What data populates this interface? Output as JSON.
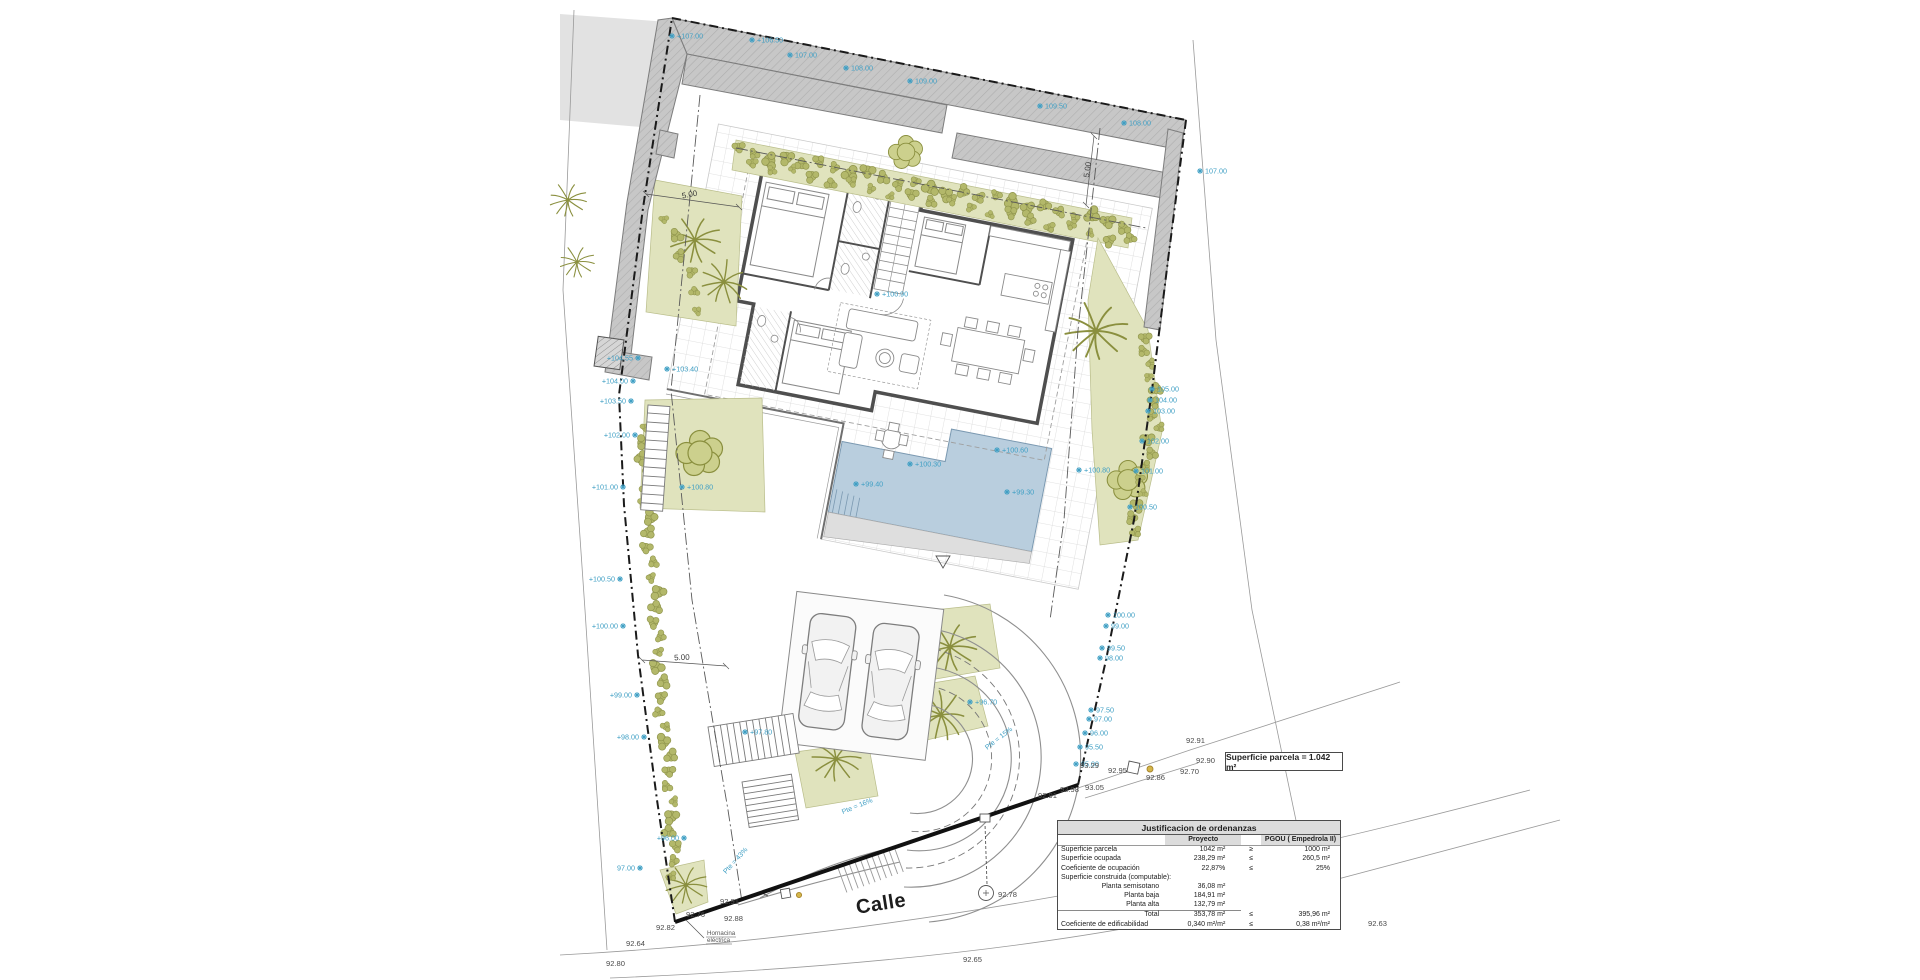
{
  "labels": {
    "street": "Calle",
    "parcel_area_box": "Superficie parcela = 1.042 m²",
    "electrical_niche": "Hornacina eléctrica"
  },
  "spot_elevations": [
    {
      "t": "+107.00",
      "x": 672,
      "y": 36,
      "a": "s"
    },
    {
      "t": "+106.50",
      "x": 752,
      "y": 40,
      "a": "s"
    },
    {
      "t": "107.00",
      "x": 790,
      "y": 55,
      "a": "s"
    },
    {
      "t": "108.00",
      "x": 846,
      "y": 68,
      "a": "s"
    },
    {
      "t": "109.00",
      "x": 910,
      "y": 81,
      "a": "s"
    },
    {
      "t": "109.50",
      "x": 1040,
      "y": 106,
      "a": "s"
    },
    {
      "t": "108.00",
      "x": 1124,
      "y": 123,
      "a": "s"
    },
    {
      "t": "107.00",
      "x": 1200,
      "y": 171,
      "a": "s"
    },
    {
      "t": "+104.55",
      "x": 638,
      "y": 358,
      "a": "e"
    },
    {
      "t": "+104.00",
      "x": 633,
      "y": 381,
      "a": "e"
    },
    {
      "t": "+103.50",
      "x": 631,
      "y": 401,
      "a": "e"
    },
    {
      "t": "+102.00",
      "x": 635,
      "y": 435,
      "a": "e"
    },
    {
      "t": "+101.00",
      "x": 623,
      "y": 487,
      "a": "e"
    },
    {
      "t": "+100.50",
      "x": 620,
      "y": 579,
      "a": "e"
    },
    {
      "t": "+100.00",
      "x": 623,
      "y": 626,
      "a": "e"
    },
    {
      "t": "+99.00",
      "x": 637,
      "y": 695,
      "a": "e"
    },
    {
      "t": "+98.00",
      "x": 644,
      "y": 737,
      "a": "e"
    },
    {
      "t": "+96.00",
      "x": 684,
      "y": 838,
      "a": "e"
    },
    {
      "t": "97.00",
      "x": 640,
      "y": 868,
      "a": "e"
    },
    {
      "t": "105.00",
      "x": 1152,
      "y": 389,
      "a": "s"
    },
    {
      "t": "104.00",
      "x": 1150,
      "y": 400,
      "a": "s"
    },
    {
      "t": "103.00",
      "x": 1148,
      "y": 411,
      "a": "s"
    },
    {
      "t": "102.00",
      "x": 1142,
      "y": 441,
      "a": "s"
    },
    {
      "t": "101.00",
      "x": 1136,
      "y": 471,
      "a": "s"
    },
    {
      "t": "100.50",
      "x": 1130,
      "y": 507,
      "a": "s"
    },
    {
      "t": "100.00",
      "x": 1108,
      "y": 615,
      "a": "s"
    },
    {
      "t": "99.00",
      "x": 1106,
      "y": 626,
      "a": "s"
    },
    {
      "t": "99.50",
      "x": 1102,
      "y": 648,
      "a": "s"
    },
    {
      "t": "98.00",
      "x": 1100,
      "y": 658,
      "a": "s"
    },
    {
      "t": "97.50",
      "x": 1091,
      "y": 710,
      "a": "s"
    },
    {
      "t": "97.00",
      "x": 1089,
      "y": 719,
      "a": "s"
    },
    {
      "t": "96.00",
      "x": 1085,
      "y": 733,
      "a": "s"
    },
    {
      "t": "95.50",
      "x": 1080,
      "y": 747,
      "a": "s"
    },
    {
      "t": "95.00",
      "x": 1076,
      "y": 764,
      "a": "s"
    },
    {
      "t": "+100.60",
      "x": 997,
      "y": 450,
      "a": "s"
    },
    {
      "t": "+100.30",
      "x": 910,
      "y": 464,
      "a": "s"
    },
    {
      "t": "+99.40",
      "x": 856,
      "y": 484,
      "a": "s"
    },
    {
      "t": "+99.30",
      "x": 1007,
      "y": 492,
      "a": "s"
    },
    {
      "t": "+100.80",
      "x": 1079,
      "y": 470,
      "a": "s"
    },
    {
      "t": "+100.80",
      "x": 682,
      "y": 487,
      "a": "s"
    },
    {
      "t": "+100.90",
      "x": 877,
      "y": 294,
      "a": "s"
    },
    {
      "t": "+103.40",
      "x": 667,
      "y": 369,
      "a": "s"
    },
    {
      "t": "+96.70",
      "x": 970,
      "y": 702,
      "a": "s"
    },
    {
      "t": "+97.80",
      "x": 745,
      "y": 732,
      "a": "s"
    }
  ],
  "survey_points": [
    {
      "t": "92.91",
      "x": 1186,
      "y": 743
    },
    {
      "t": "92.90",
      "x": 1196,
      "y": 763
    },
    {
      "t": "92.70",
      "x": 1180,
      "y": 774
    },
    {
      "t": "92.95",
      "x": 1108,
      "y": 773
    },
    {
      "t": "92.86",
      "x": 1146,
      "y": 780
    },
    {
      "t": "93.29",
      "x": 1080,
      "y": 768
    },
    {
      "t": "93.05",
      "x": 1085,
      "y": 790
    },
    {
      "t": "92.98",
      "x": 1060,
      "y": 792
    },
    {
      "t": "92.91",
      "x": 1038,
      "y": 798
    },
    {
      "t": "92.91",
      "x": 720,
      "y": 904
    },
    {
      "t": "92.88",
      "x": 724,
      "y": 921
    },
    {
      "t": "92.76",
      "x": 686,
      "y": 917
    },
    {
      "t": "92.82",
      "x": 656,
      "y": 930
    },
    {
      "t": "92.64",
      "x": 626,
      "y": 946
    },
    {
      "t": "92.80",
      "x": 606,
      "y": 966
    },
    {
      "t": "92.78",
      "x": 998,
      "y": 897
    },
    {
      "t": "92.65",
      "x": 963,
      "y": 962
    },
    {
      "t": "92.63",
      "x": 1368,
      "y": 926
    }
  ],
  "dim_labels": [
    {
      "t": "5.00",
      "x": 690,
      "y": 197,
      "r": -11
    },
    {
      "t": "5.00",
      "x": 1090,
      "y": 170,
      "r": -82
    },
    {
      "t": "5.00",
      "x": 682,
      "y": 660,
      "r": -3
    }
  ],
  "slope_labels": [
    {
      "t": "Pte = 15%",
      "x": 1000,
      "y": 740,
      "r": -38
    },
    {
      "t": "Pte = 16%",
      "x": 858,
      "y": 808,
      "r": -22
    },
    {
      "t": "Pte = 43%",
      "x": 737,
      "y": 862,
      "r": -48
    }
  ],
  "table": {
    "title": "Justificacion de ordenanzas",
    "col_headers": [
      "",
      "Proyecto",
      "",
      "PGOU ( Empedrola II)"
    ],
    "rows": [
      {
        "l": "Superficie parcela",
        "p": "1042 m²",
        "c": "≥",
        "g": "1000 m²",
        "cls": ""
      },
      {
        "l": "Superficie ocupada",
        "p": "238,29 m²",
        "c": "≤",
        "g": "260,5 m²",
        "cls": ""
      },
      {
        "l": "Coeficiente de ocupación",
        "p": "22,87%",
        "c": "≤",
        "g": "25%",
        "cls": ""
      },
      {
        "l": "Superficie construida (computable):",
        "p": "",
        "c": "",
        "g": "",
        "cls": "section"
      },
      {
        "l": "Planta semisotano",
        "p": "36,08 m²",
        "c": "",
        "g": "",
        "cls": "indent"
      },
      {
        "l": "Planta baja",
        "p": "184,91 m²",
        "c": "",
        "g": "",
        "cls": "indent"
      },
      {
        "l": "Planta alta",
        "p": "132,79 m²",
        "c": "",
        "g": "",
        "cls": "indent"
      },
      {
        "l": "Total",
        "p": "353,78 m²",
        "c": "≤",
        "g": "395,96 m²",
        "cls": "total"
      },
      {
        "l": "Coeficiente de edificabilidad",
        "p": "0,340 m²/m²",
        "c": "≤",
        "g": "0,38 m²/m²",
        "cls": ""
      }
    ]
  },
  "colors": {
    "label_blue": "#3f9fc4",
    "vegetation_fill": "#e0e3bd",
    "plant_stroke": "#8a8f3e",
    "pool_fill": "#b9cede",
    "band_fill": "#c6c6c6",
    "wall_dark": "#4f4f4f",
    "table_header_bg": "#dcdcdc"
  }
}
